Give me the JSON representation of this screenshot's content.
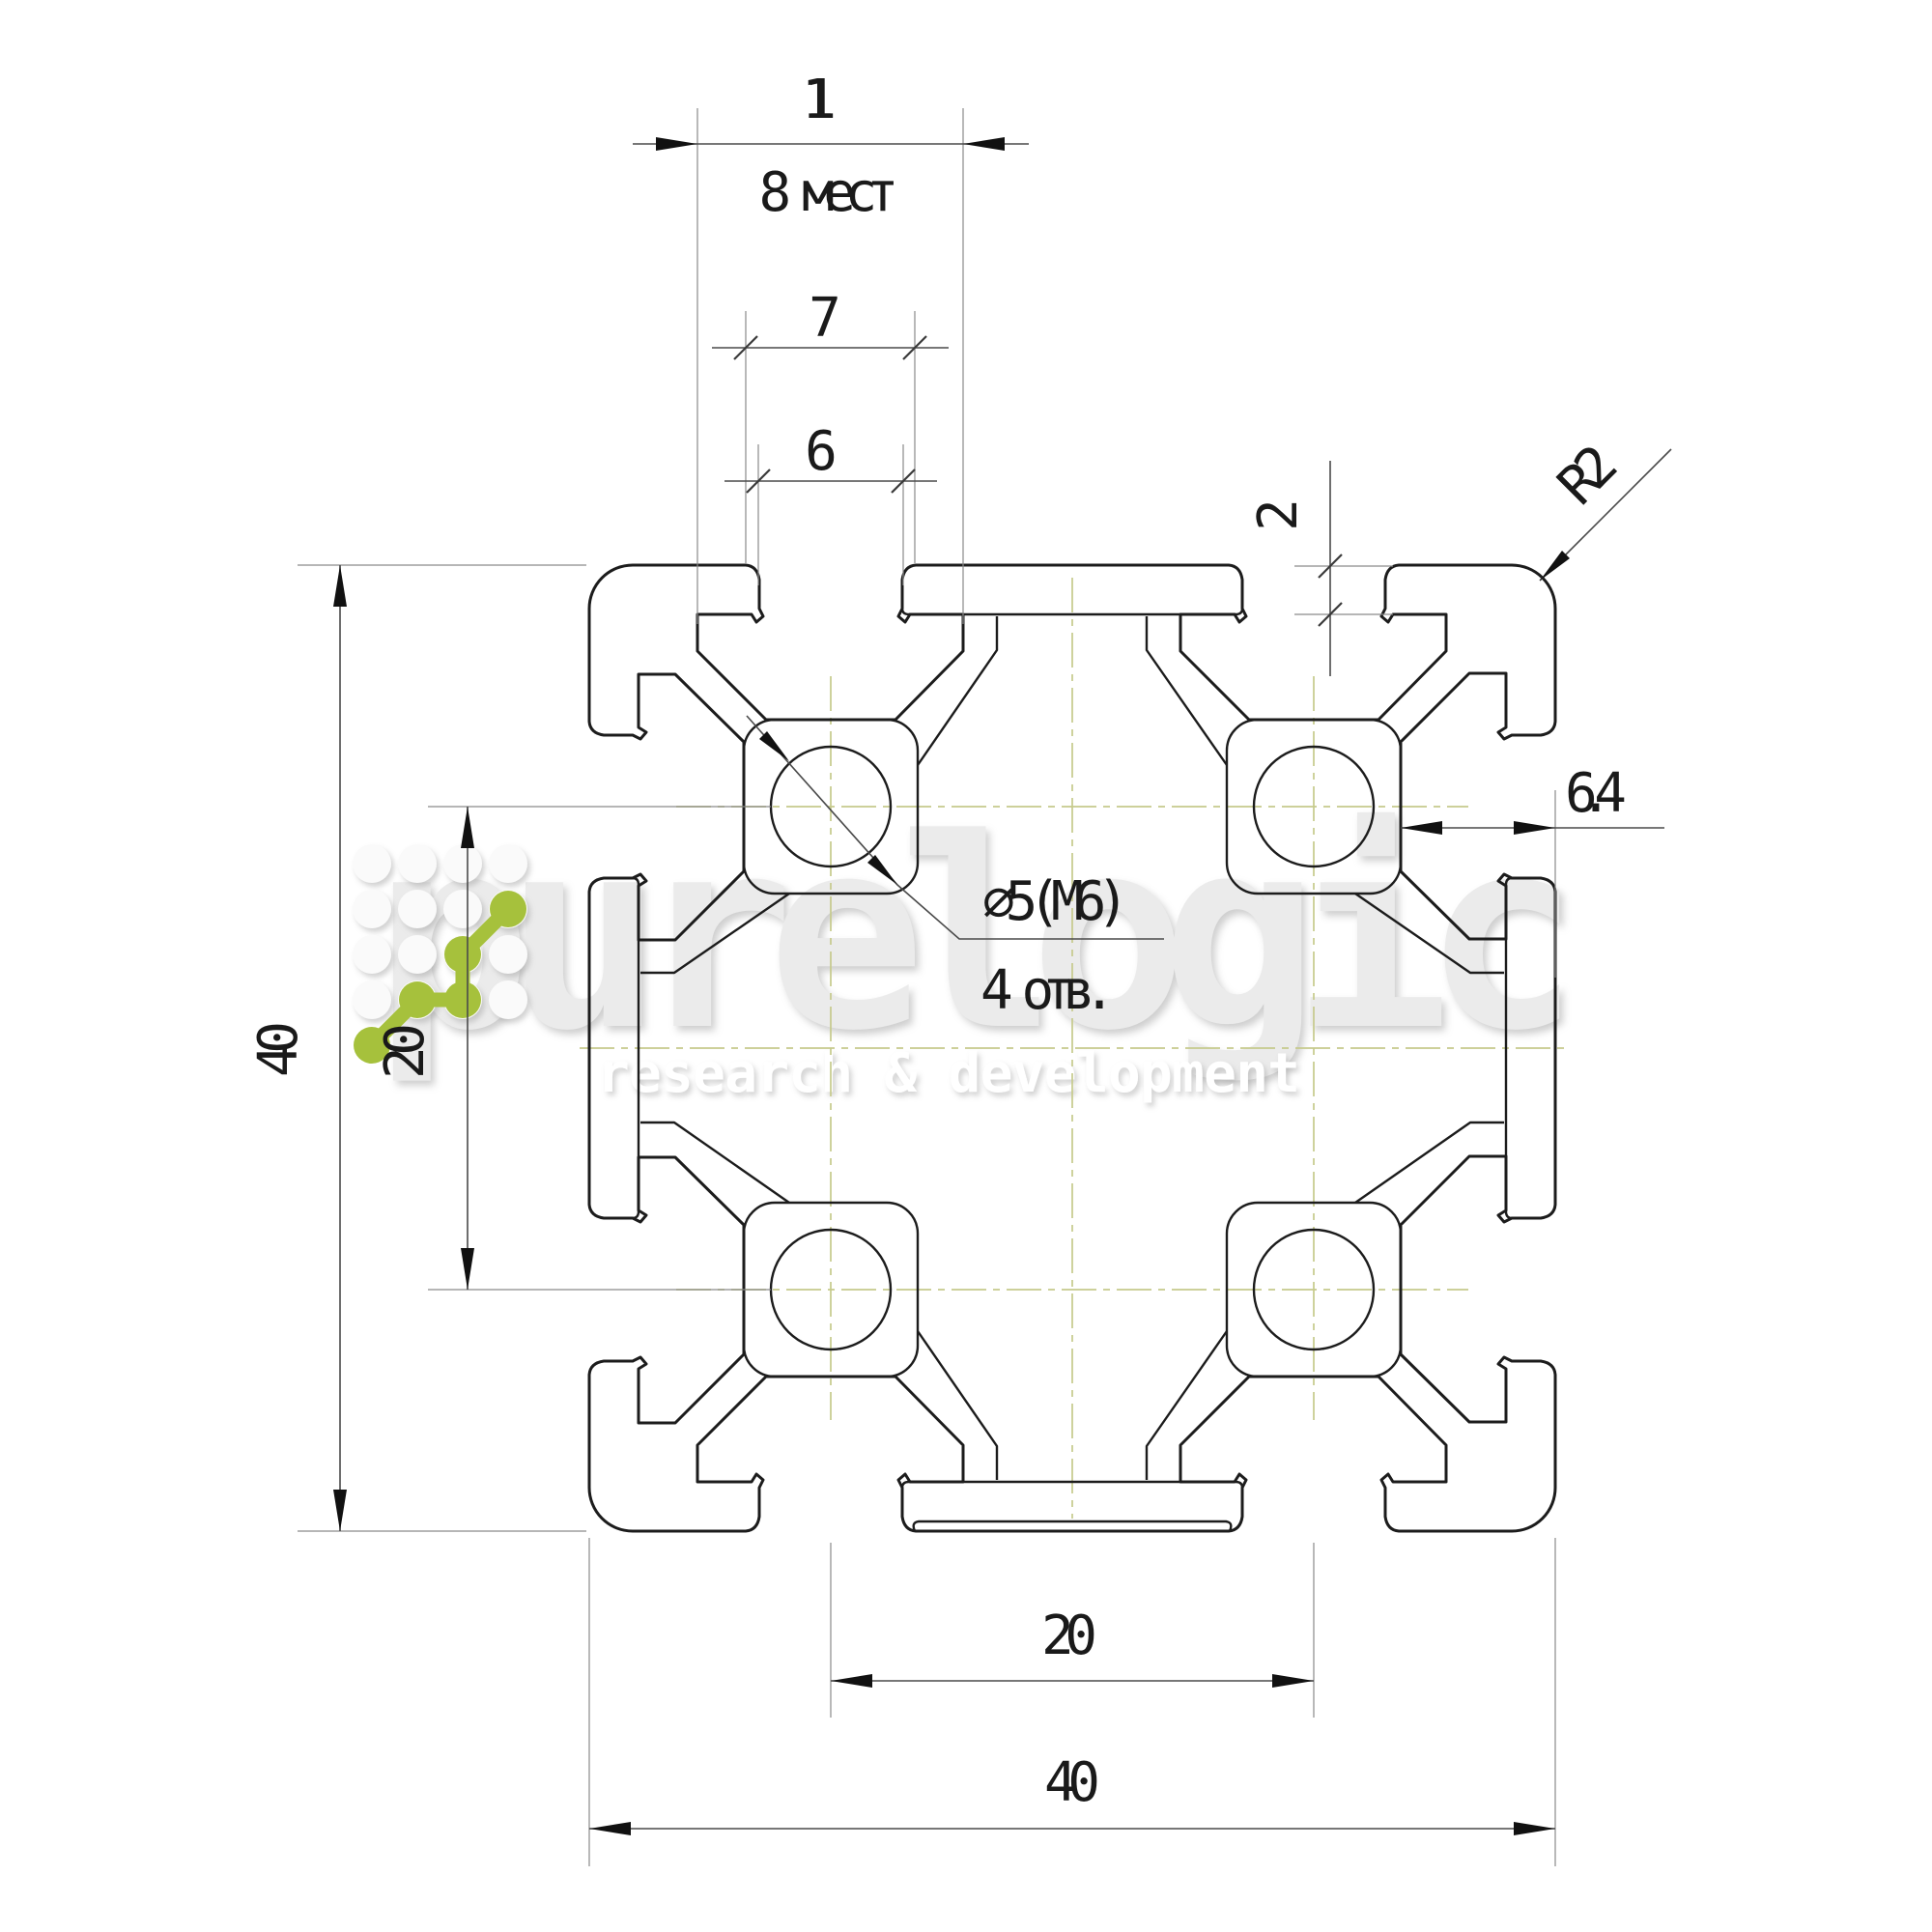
{
  "drawing": {
    "dimensions": {
      "slot_cavity_width": "11",
      "slot_places_note": "8 мест",
      "slot_step_width": "7",
      "slot_opening_width": "6",
      "lip_thickness": "2",
      "corner_radius": "R2",
      "slot_depth": "6.4",
      "profile_height": "40",
      "hole_spacing_vertical": "20",
      "hole_diameter": "∅5(M6)",
      "hole_count_note": "4 отв.",
      "hole_spacing_horizontal": "20",
      "profile_width": "40"
    },
    "watermark": {
      "brand": "purelogic",
      "tagline": "research & development"
    },
    "colors": {
      "line": "#1c1c1c",
      "dimension": "#4a4a4a",
      "centerline": "#c6ca8c",
      "watermark_gray": "#ebebeb",
      "logo_green": "#a6c13c"
    }
  }
}
